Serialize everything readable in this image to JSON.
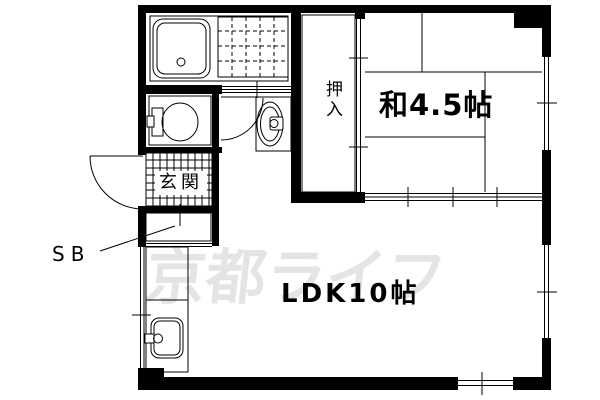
{
  "title": "apartment-floorplan",
  "watermark": {
    "text": "京都ライフ",
    "color": "#e4e4e4"
  },
  "labels": {
    "japanese_room": "和4.5帖",
    "closet": "押入",
    "entrance": "玄関",
    "shoe_box": "SB",
    "living_dining_kitchen": "LDK10帖"
  },
  "colors": {
    "line": "#000000",
    "background": "#ffffff",
    "watermark": "#e4e4e4"
  },
  "fixtures": [
    "bathtub-icon",
    "bath-tile-floor",
    "toilet-icon",
    "washbasin-icon",
    "kitchen-sink-icon",
    "entrance-door-swing",
    "washroom-door-swing",
    "fusuma-sliding-door",
    "window"
  ]
}
